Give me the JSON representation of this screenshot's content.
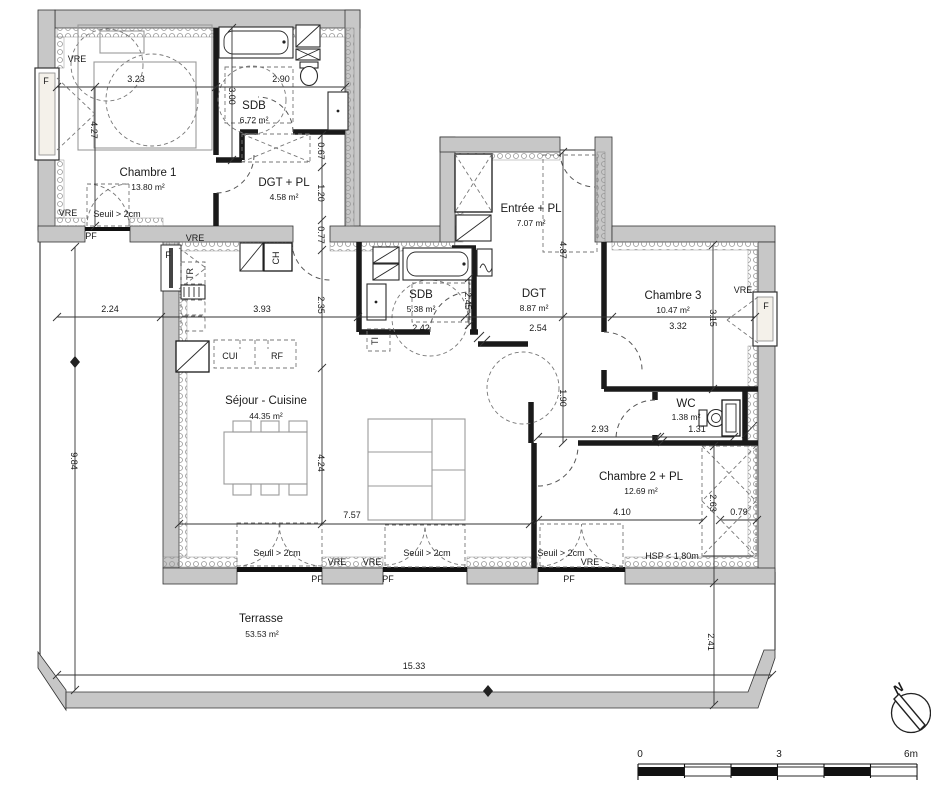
{
  "rooms": [
    {
      "name": "Chambre 1",
      "area": "13.80 m²"
    },
    {
      "name": "SDB",
      "area": "6.72 m²"
    },
    {
      "name": "DGT + PL",
      "area": "4.58 m²"
    },
    {
      "name": "Entrée + PL",
      "area": "7.07 m²"
    },
    {
      "name": "SDB",
      "area": "5.38 m²"
    },
    {
      "name": "DGT",
      "area": "8.87 m²"
    },
    {
      "name": "Chambre 3",
      "area": "10.47 m²"
    },
    {
      "name": "WC",
      "area": "1.38 m²"
    },
    {
      "name": "Séjour - Cuisine",
      "area": "44.35 m²"
    },
    {
      "name": "Chambre 2 + PL",
      "area": "12.69 m²"
    },
    {
      "name": "Terrasse",
      "area": "53.53 m²"
    }
  ],
  "dims": {
    "ch1_w": "3.23",
    "sdb1_w": "2.90",
    "sdb1_h": "3.00",
    "ch1_h": "4.27",
    "p067": "0.67",
    "p120": "1.20",
    "p077": "0.77",
    "terr_left_w": "2.24",
    "terr_left_h": "9.84",
    "kitchen_w": "3.93",
    "sej_upper_h": "2.35",
    "sdb2_w": "2.42",
    "sdb2_h": "2.45",
    "dgt_w": "2.54",
    "entree_h": "4.87",
    "dgt_h": "1.90",
    "ch3_w": "3.32",
    "ch3_h": "3.15",
    "ch2_left": "2.93",
    "wc_w": "1.31",
    "sej_h": "4.24",
    "sej_w": "7.57",
    "ch2_w": "4.10",
    "ch2_h": "2.63",
    "slope_w": "0.79",
    "terr_w": "15.33",
    "terr_b_h": "2.41"
  },
  "ann": {
    "vre": "VRE",
    "pf": "PF",
    "f": "F",
    "seuil": "Seuil > 2cm",
    "hsp": "HSP < 1,80m",
    "cui": "CUI",
    "rf": "RF",
    "ch": "CH",
    "tr": "TR",
    "ti": "TI"
  },
  "compass": {
    "north": "N"
  },
  "scale_bar": {
    "t0": "0",
    "t3": "3",
    "t6": "6m"
  }
}
